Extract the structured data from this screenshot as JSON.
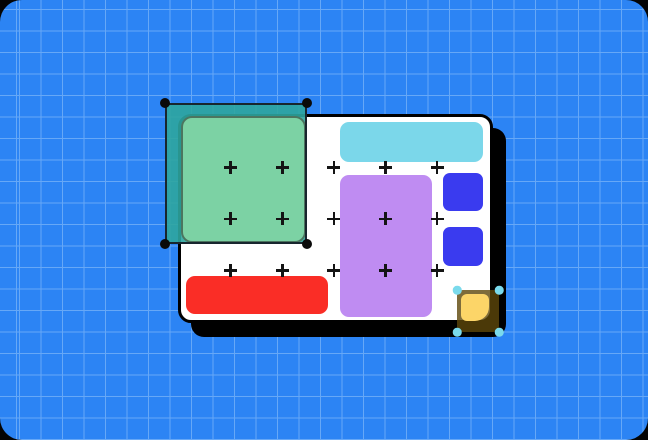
{
  "scene": {
    "description": "Design-tool canvas illustration: white artboard with colored blocks on a blue grid, a green rectangle inside a dark-teal marquee selection with black corner handles, and a yellow square inside an amber selection with cyan corner handles"
  },
  "colors": {
    "bg": "#2C84F4",
    "grid-line": "#66A8F7",
    "card-bg": "#FFFFFF",
    "card-border": "#000000",
    "card-shadow": "#000000",
    "cyan-bar": "#7BD7EA",
    "purple-rect": "#BF8CF2",
    "blue-square": "#3A3BEF",
    "red-bar": "#FA2D26",
    "green-rect": "#7CD2A4",
    "teal-selection": "rgba(45,165,158,0.9)",
    "selection-border": "#18262E",
    "dark-handle": "#0A0A0A",
    "amber-selection": "rgba(94,71,10,0.8)",
    "yellow-square": "#FCD568",
    "cyan-handle": "#7ADAEC",
    "plus-marker": "#141414"
  },
  "plus_grid": {
    "rows": 3,
    "cols": 5
  },
  "selections": [
    {
      "target": "green-rectangle",
      "handle_style": "black-circles",
      "handle_count": 4
    },
    {
      "target": "yellow-square",
      "handle_style": "cyan-circles",
      "handle_count": 4
    }
  ]
}
